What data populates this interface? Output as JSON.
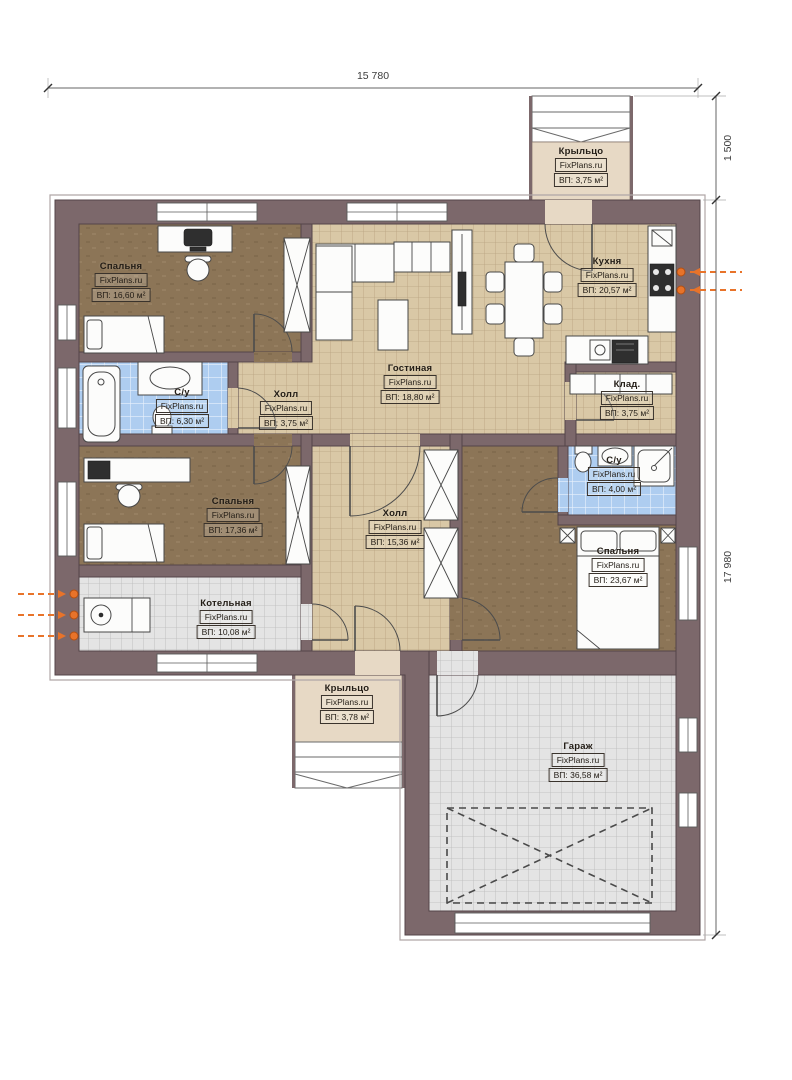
{
  "watermark": "FixPlans.ru",
  "dimensions": {
    "top": "15 780",
    "porch_right": "1 500",
    "right": "17 980"
  },
  "rooms": [
    {
      "key": "porch-top",
      "name": "Крыльцо",
      "area": "ВП: 3,75 м²"
    },
    {
      "key": "bedroom-1",
      "name": "Спальня",
      "area": "ВП: 16,60 м²"
    },
    {
      "key": "kitchen",
      "name": "Кухня",
      "area": "ВП: 20,57 м²"
    },
    {
      "key": "living-room",
      "name": "Гостиная",
      "area": "ВП: 18,80 м²"
    },
    {
      "key": "bathroom-1",
      "name": "С/у",
      "area": "ВП: 6,30 м²"
    },
    {
      "key": "hall-1",
      "name": "Холл",
      "area": "ВП: 3,75 м²"
    },
    {
      "key": "storage",
      "name": "Клад.",
      "area": "ВП: 3,75 м²"
    },
    {
      "key": "bathroom-2",
      "name": "С/у",
      "area": "ВП: 4,00 м²"
    },
    {
      "key": "bedroom-2",
      "name": "Спальня",
      "area": "ВП: 17,36 м²"
    },
    {
      "key": "hall-2",
      "name": "Холл",
      "area": "ВП: 15,36 м²"
    },
    {
      "key": "bedroom-3",
      "name": "Спальня",
      "area": "ВП: 23,67 м²"
    },
    {
      "key": "boiler-room",
      "name": "Котельная",
      "area": "ВП: 10,08 м²"
    },
    {
      "key": "porch-bottom",
      "name": "Крыльцо",
      "area": "ВП: 3,78 м²"
    },
    {
      "key": "garage",
      "name": "Гараж",
      "area": "ВП: 36,58 м²"
    }
  ],
  "colors": {
    "wall": "#7c686b",
    "tile_beige": "#d9c8a6",
    "tile_blue": "#aecdf0",
    "tile_gray": "#e4e4e4",
    "floor_brown": "#8c7557",
    "porch": "#e7d9c5",
    "utility_orange": "#e8732a"
  }
}
